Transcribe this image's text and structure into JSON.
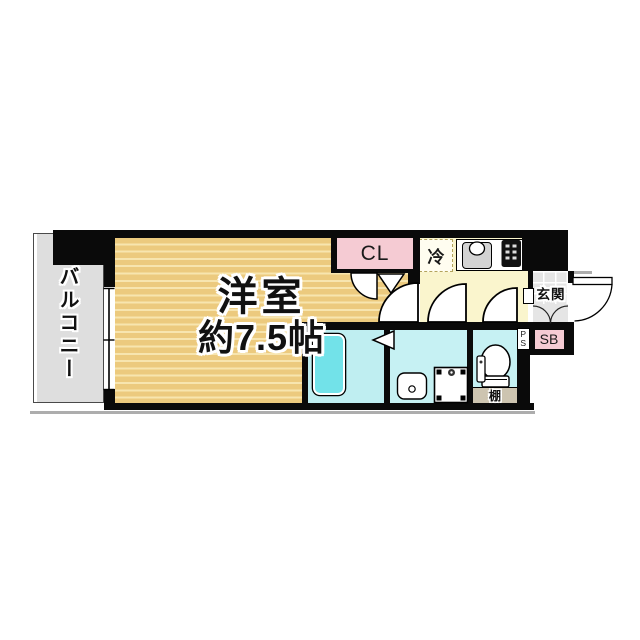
{
  "floorplan": {
    "balcony": {
      "label": "バルコニー"
    },
    "main_room": {
      "label_line1": "洋室",
      "label_line2": "約7.5帖"
    },
    "closet": {
      "label": "CL"
    },
    "kitchen": {
      "refrigerator_label": "冷"
    },
    "entrance": {
      "label": "玄関"
    },
    "shoe_box": {
      "label": "SB"
    },
    "pipe_space": {
      "letter1": "P",
      "letter2": "S"
    },
    "shelf": {
      "label": "棚"
    },
    "fixture_icons": [
      "bathtub-icon",
      "wash-basin-icon",
      "washing-machine-pan-icon",
      "toilet-icon",
      "kitchen-sink-icon",
      "stove-icon",
      "refrigerator-space-dashed-box",
      "door-swing-arc",
      "folding-door-triangle",
      "sliding-window-symbol",
      "entrance-step-fan-curves"
    ],
    "colors": {
      "wall": "#0a0a0a",
      "room_floor": "#ecca7e",
      "room_floor_stripe": "#f7e5af",
      "balcony_gray": "#dedede",
      "closet_pink": "#f5cbd3",
      "shoe_box_pink": "#f5cbd3",
      "kitchen_yellow": "#faf5cd",
      "wet_area_cyan": "#c6f1f3",
      "bathroom_cyan": "#bfeef1",
      "bathtub_cyan": "#72e2e9",
      "shelf_gray": "#cdc4b0",
      "entrance_tile_gray": "#e5e5e5",
      "shadow_gray": "#adadad"
    }
  }
}
